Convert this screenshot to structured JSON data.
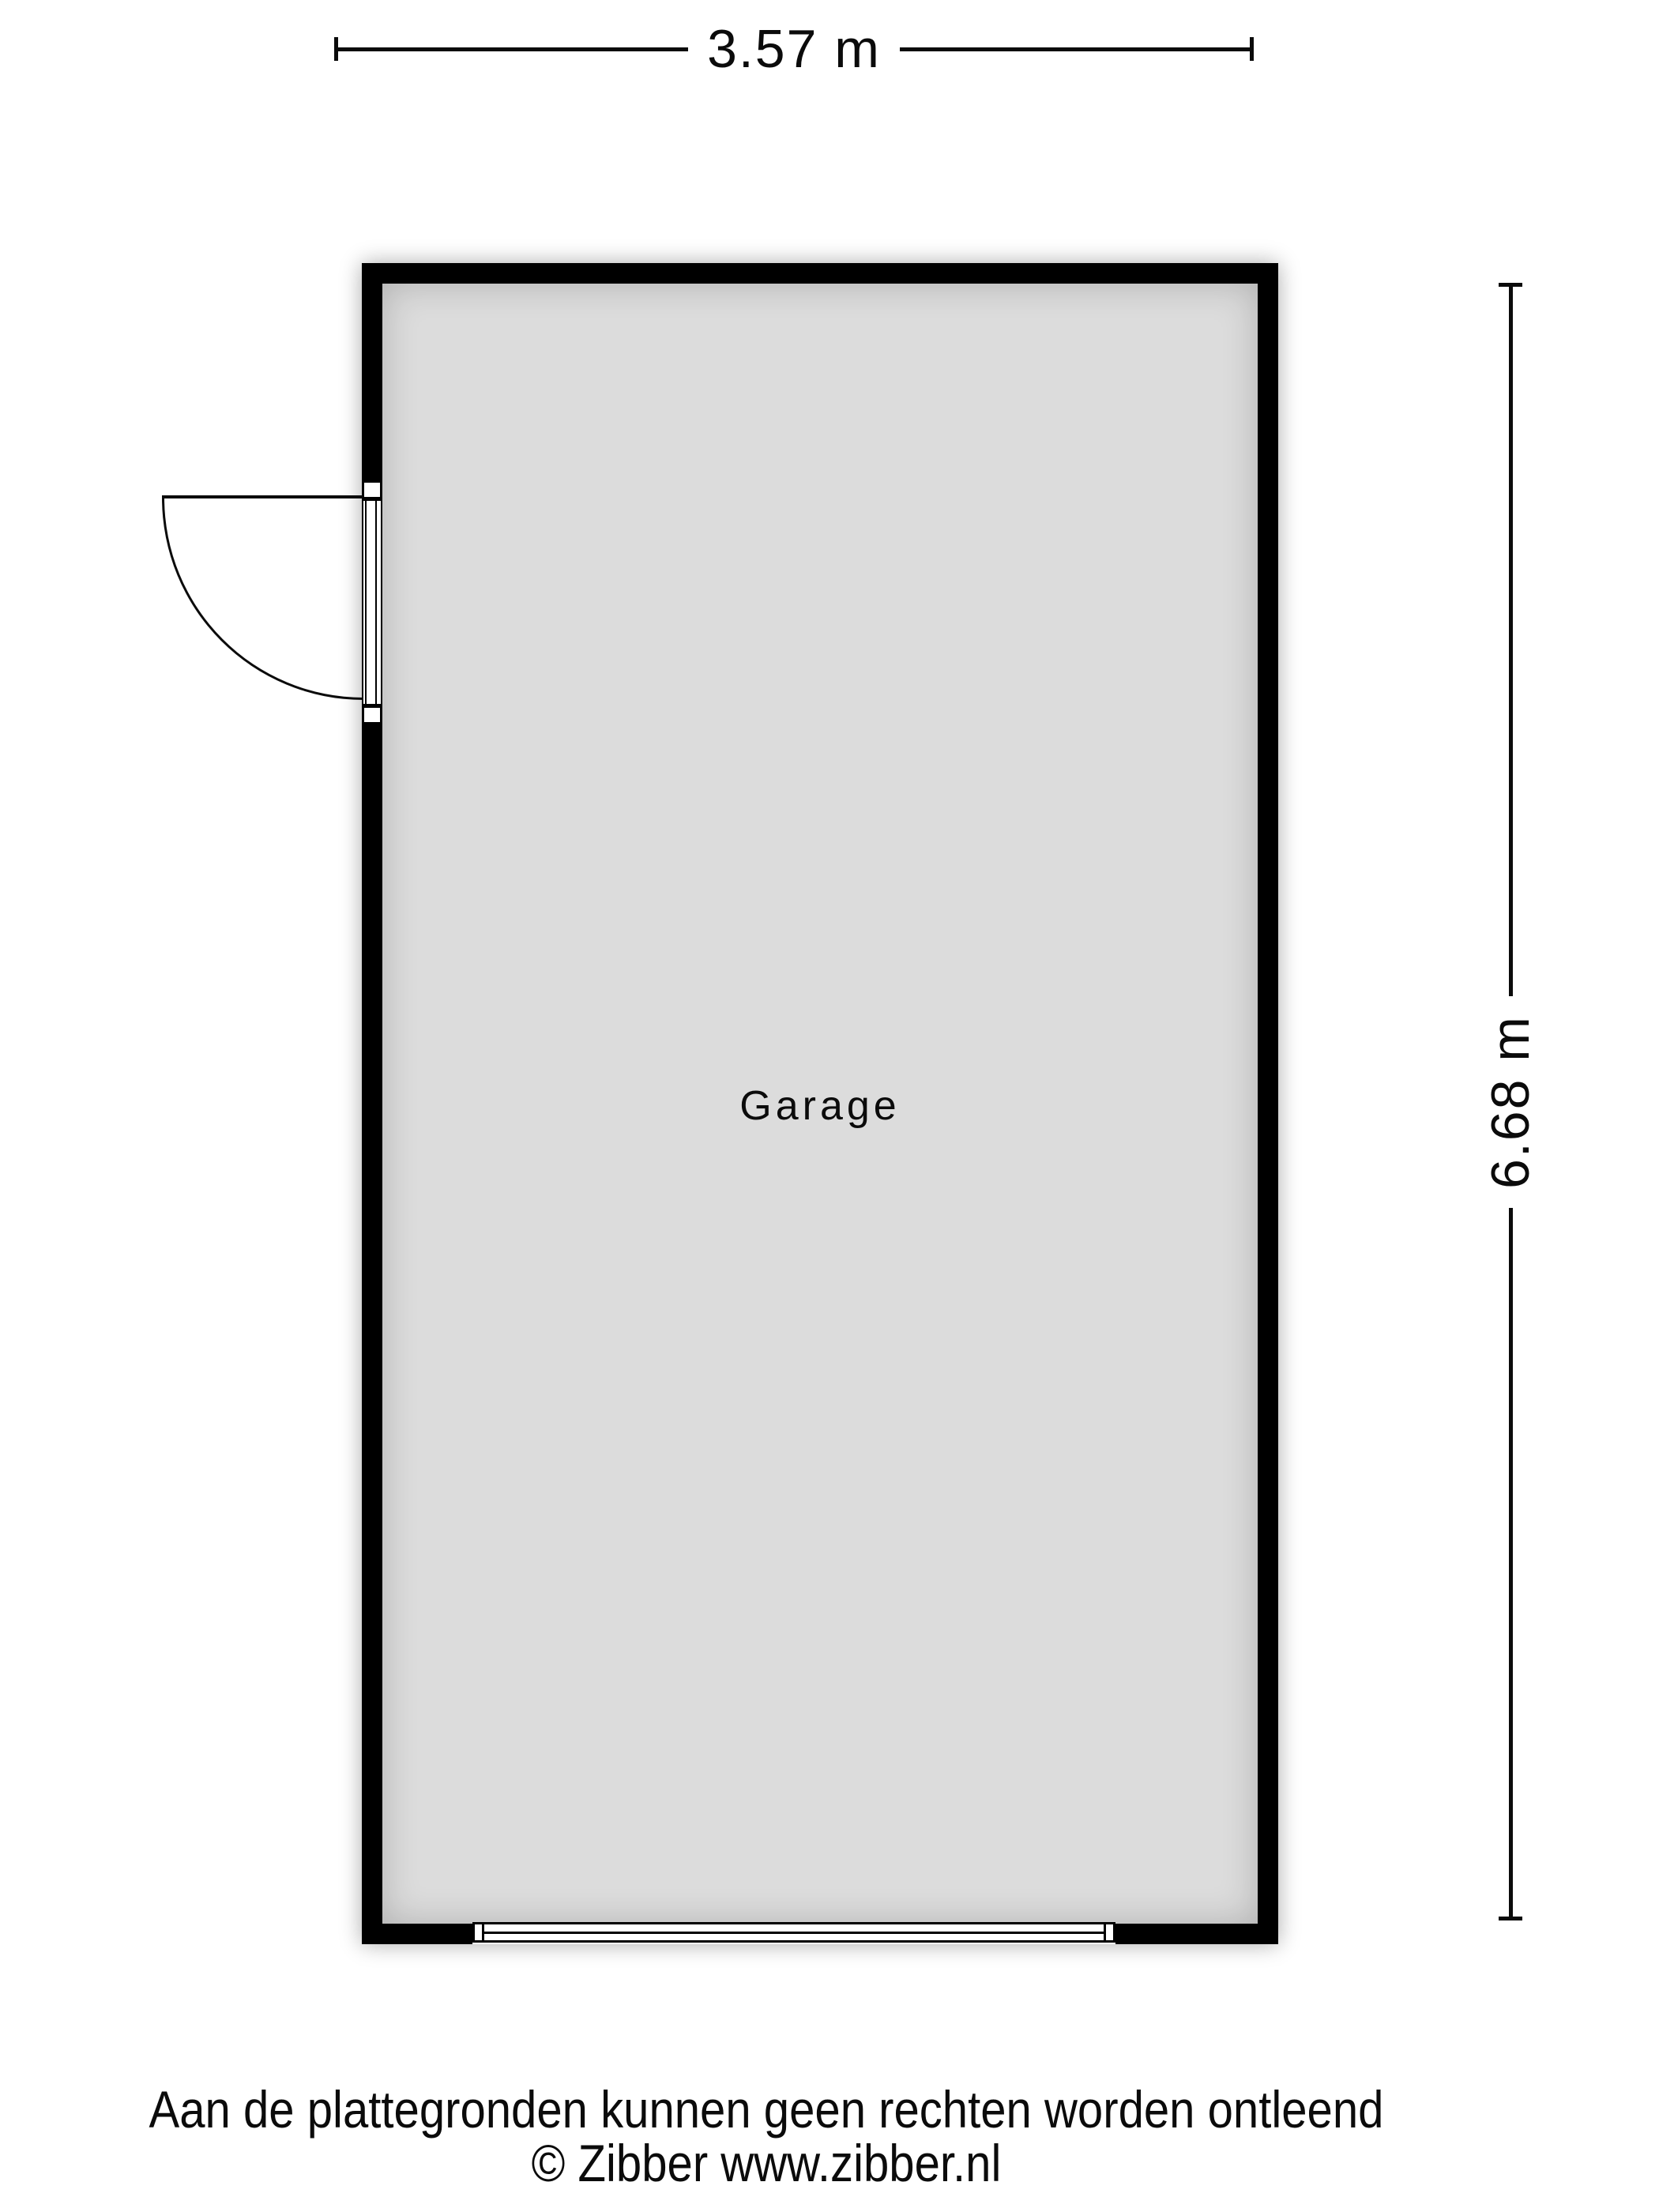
{
  "page": {
    "background": "#ffffff",
    "type": "floorplan"
  },
  "dimensions": {
    "width": {
      "label": "3.57 m"
    },
    "height": {
      "label": "6.68 m"
    }
  },
  "room": {
    "label": "Garage",
    "wall_color": "#000000",
    "floor_color": "#dcdcdc"
  },
  "symbols": {
    "entry_door": "door-swing-arc",
    "garage_door": "garage-door-panel"
  },
  "footer": {
    "line1": "Aan de plattegronden kunnen geen rechten worden ontleend",
    "line2": "© Zibber www.zibber.nl"
  }
}
